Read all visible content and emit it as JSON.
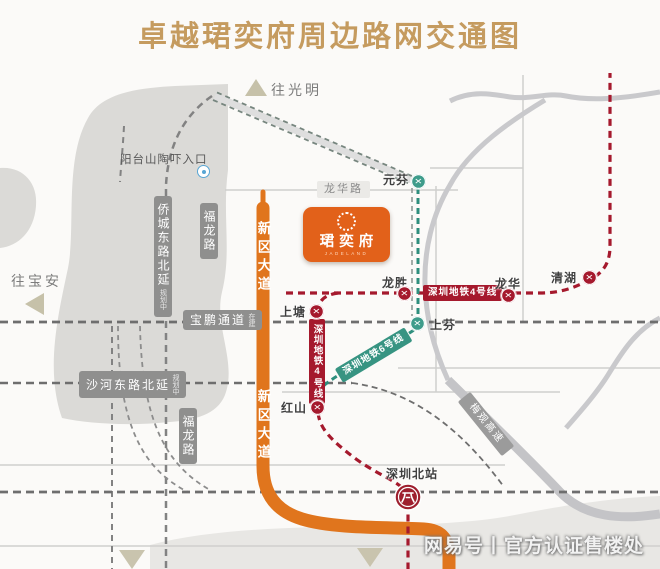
{
  "title": "卓越珺奕府周边路网交通图",
  "project": {
    "name": "珺奕府",
    "latin": "JADELAND"
  },
  "directions": {
    "guangming": "往光明",
    "baoan": "往宝安"
  },
  "poi": {
    "yangtaishan_entrance": "阳台山陶吓入口"
  },
  "roads": {
    "longhua_rd": "龙华路",
    "fulong_rd_north": "福龙路",
    "fulong_rd_south": "福龙路",
    "qiaocheng_east_ext": "侨城东路北延",
    "qiaocheng_note": "规划中",
    "xinqu_ave_north": "新区大道",
    "xinqu_ave_south": "新区大道",
    "baopeng_channel": "宝鹏通道",
    "baopeng_note": "在建",
    "shahe_east_ext": "沙河东路北延",
    "shahe_note": "规划中",
    "meiguan_expwy": "梅观高速"
  },
  "metro": {
    "line4_label_h": "深圳地铁4号线",
    "line4_label_v": "深圳地铁4号线",
    "line6_label": "深圳地铁6号线",
    "stations": {
      "yuanfen": "元芬",
      "qinghu": "清湖",
      "longhua": "龙华",
      "longsheng": "龙胜",
      "shangtang": "上塘",
      "shangfen": "上芬",
      "hongshan": "红山",
      "shenzhen_north": "深圳北站"
    }
  },
  "watermark": {
    "brand": "网易号",
    "divider": "丨",
    "text": "官方认证售楼处"
  },
  "colors": {
    "title_gold": "#C59B5F",
    "accent_orange": "#E2611A",
    "metro_line4": "#A5192D",
    "metro_line6": "#3E9C8B",
    "road_gray": "#8f8f8e"
  }
}
